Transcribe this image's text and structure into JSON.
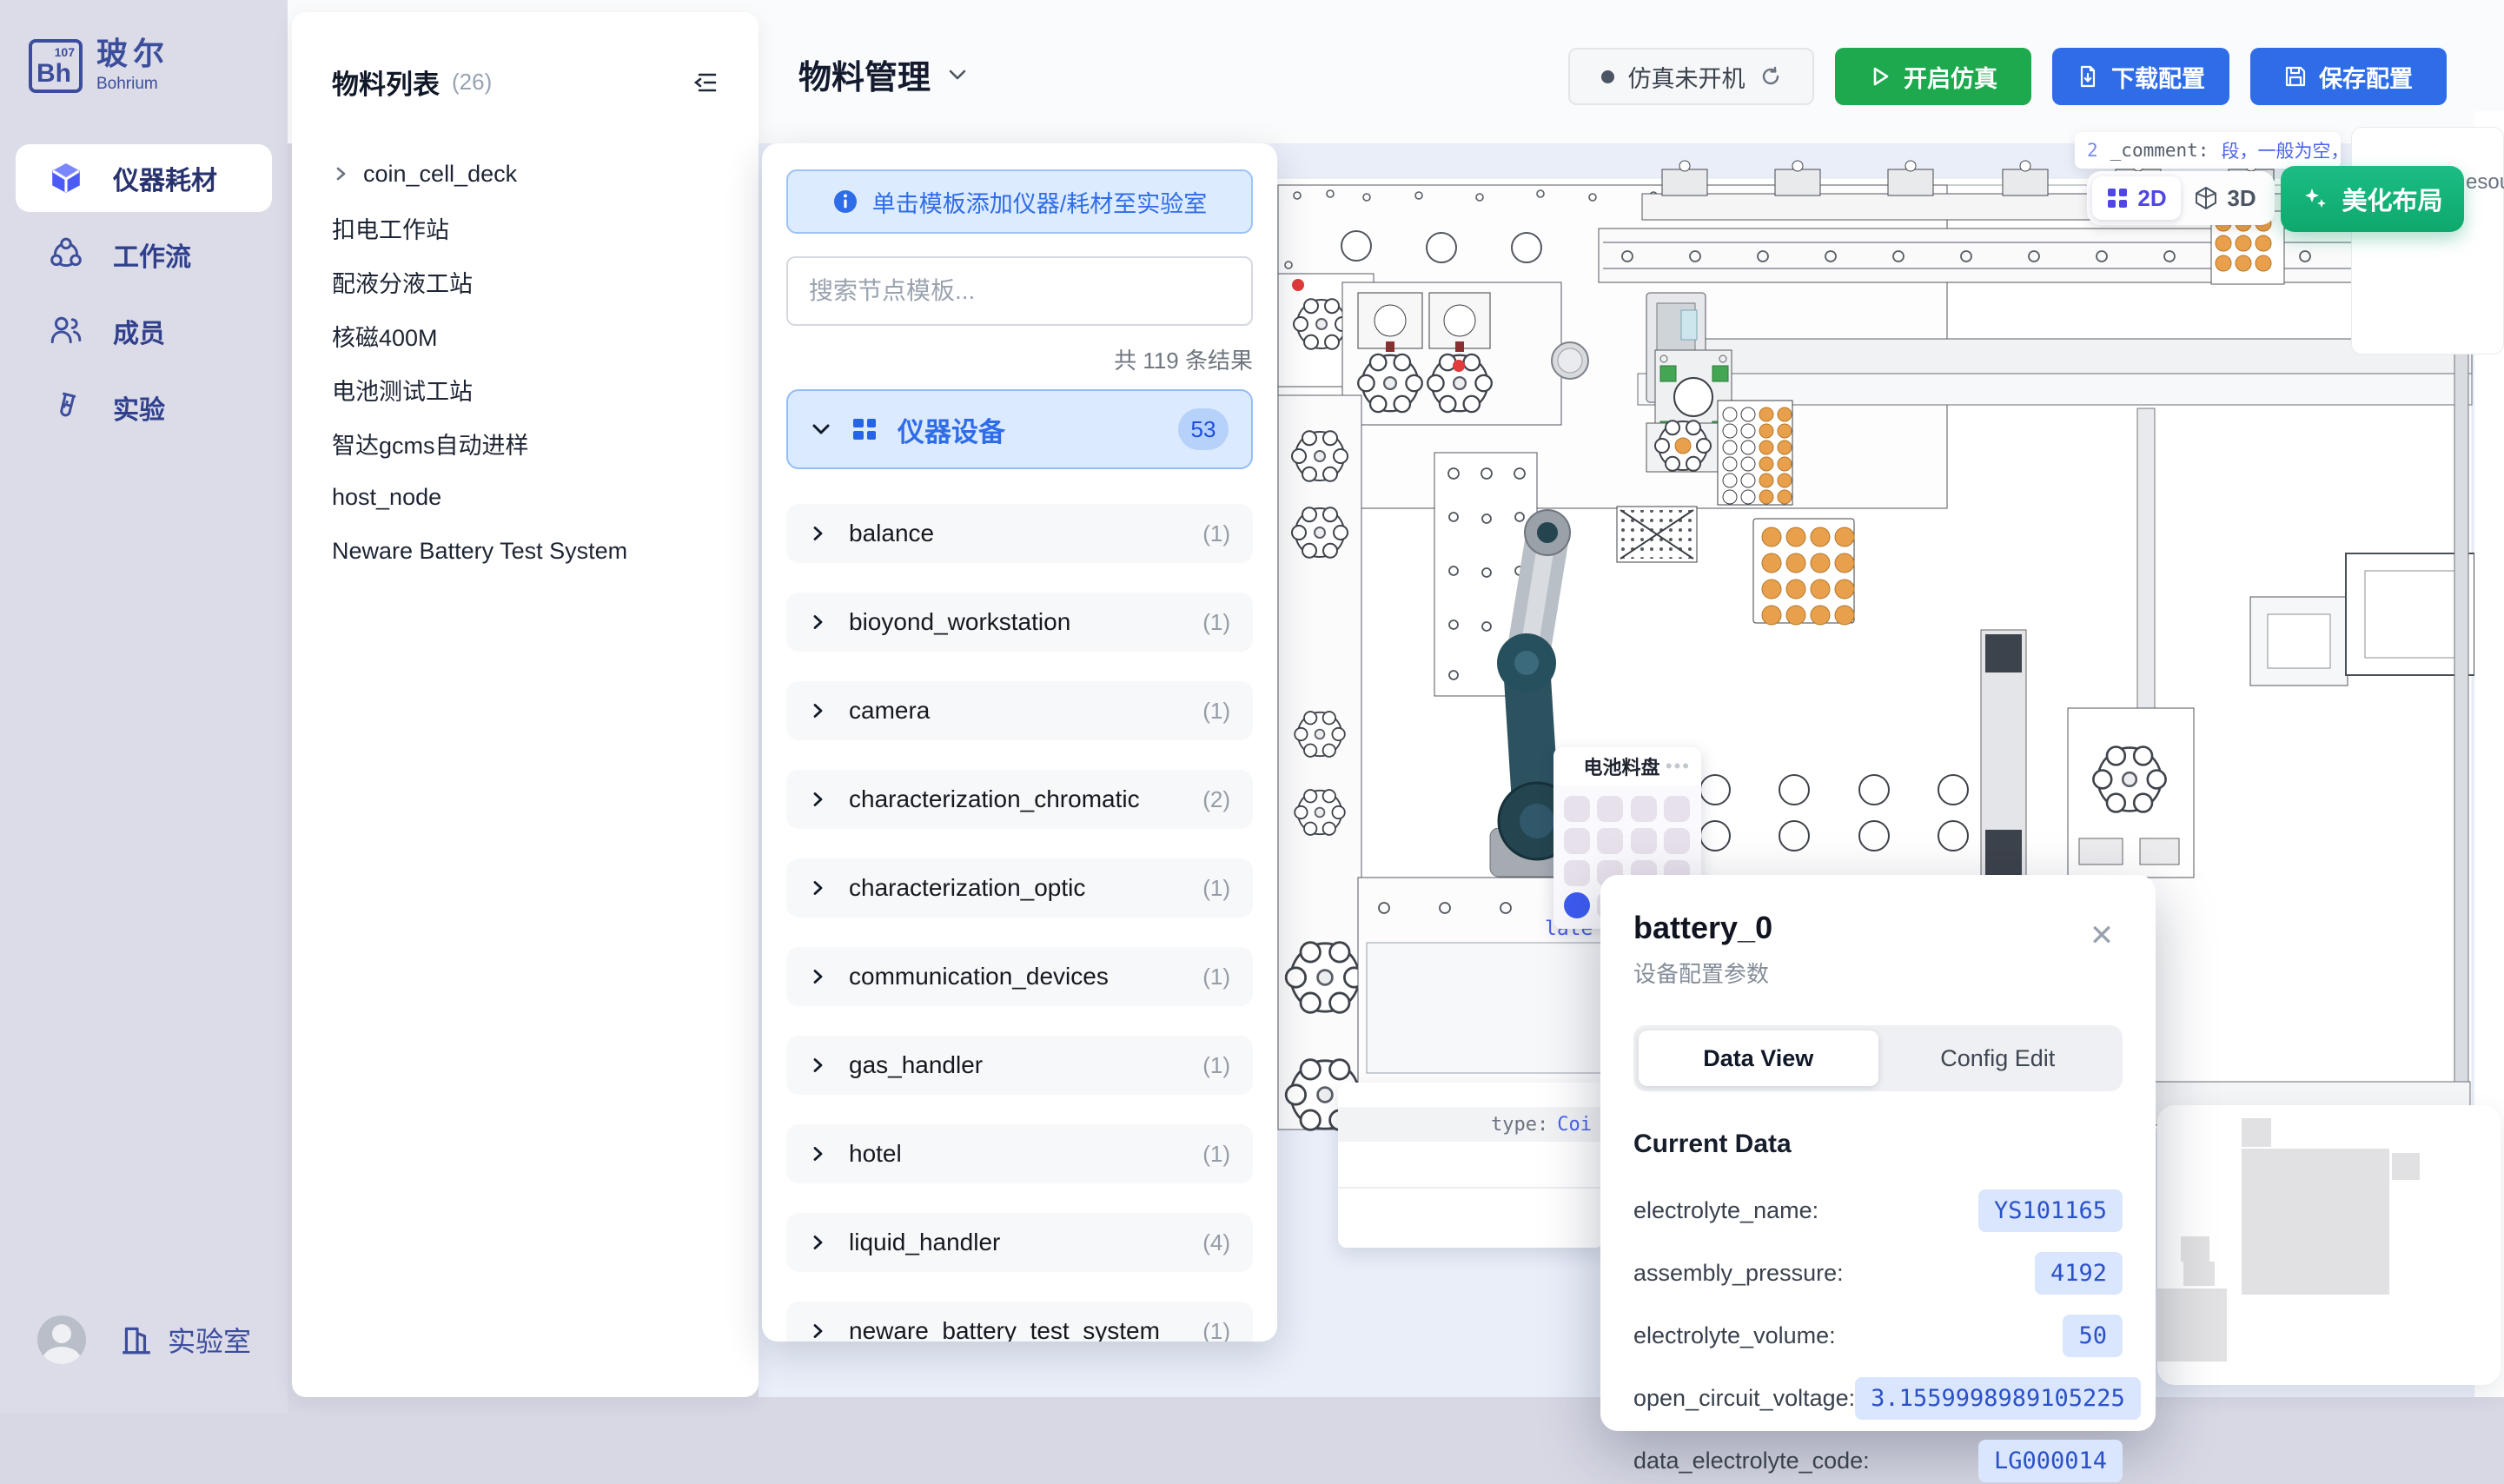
{
  "brand": {
    "logo_symbol": "Bh",
    "logo_number": "107",
    "name_cn": "玻尔",
    "name_en": "Bohrium"
  },
  "sidebar": {
    "items": [
      {
        "icon": "cube-icon",
        "label": "仪器耗材",
        "active": true
      },
      {
        "icon": "workflow-icon",
        "label": "工作流",
        "active": false
      },
      {
        "icon": "members-icon",
        "label": "成员",
        "active": false
      },
      {
        "icon": "experiment-icon",
        "label": "实验",
        "active": false
      }
    ],
    "bottom_label": "实验室"
  },
  "materials": {
    "title": "物料列表",
    "count": "(26)",
    "items": [
      {
        "label": "coin_cell_deck",
        "expandable": true
      },
      {
        "label": "扣电工作站"
      },
      {
        "label": "配液分液工站"
      },
      {
        "label": "核磁400M"
      },
      {
        "label": "电池测试工站"
      },
      {
        "label": "智达gcms自动进样"
      },
      {
        "label": "host_node"
      },
      {
        "label": "Neware Battery Test System"
      }
    ]
  },
  "header": {
    "title": "物料管理",
    "status_label": "仿真未开机",
    "buttons": {
      "start": "开启仿真",
      "download": "下载配置",
      "save": "保存配置"
    }
  },
  "template_panel": {
    "hint": "单击模板添加仪器/耗材至实验室",
    "search_placeholder": "搜索节点模板...",
    "result_count": "共 119 条结果",
    "section": {
      "label": "仪器设备",
      "badge": "53"
    },
    "items": [
      {
        "label": "balance",
        "count": "(1)"
      },
      {
        "label": "bioyond_workstation",
        "count": "(1)"
      },
      {
        "label": "camera",
        "count": "(1)"
      },
      {
        "label": "characterization_chromatic",
        "count": "(2)"
      },
      {
        "label": "characterization_optic",
        "count": "(1)"
      },
      {
        "label": "communication_devices",
        "count": "(1)"
      },
      {
        "label": "gas_handler",
        "count": "(1)"
      },
      {
        "label": "hotel",
        "count": "(1)"
      },
      {
        "label": "liquid_handler",
        "count": "(4)"
      },
      {
        "label": "neware_battery_test_system",
        "count": "(1)"
      }
    ]
  },
  "canvas": {
    "tooltip": {
      "line_no": "2",
      "key": "_comment:",
      "value": "段，一般为空，stat",
      "line2": "固定"
    },
    "view_toggle": {
      "d2": "2D",
      "d3": "3D"
    },
    "beautify_label": "美化布局",
    "clipped_text": "esou",
    "tray": {
      "title": "电池料盘",
      "rows": 4,
      "cols": 4,
      "selected_index": 12
    },
    "hover": {
      "plate_fragment": "late",
      "type_label": "type:",
      "type_value": "Coi"
    }
  },
  "popup": {
    "title": "battery_0",
    "subtitle": "设备配置参数",
    "tabs": [
      "Data View",
      "Config Edit"
    ],
    "active_tab": 0,
    "section": "Current Data",
    "rows": [
      {
        "label": "electrolyte_name:",
        "value": "YS101165"
      },
      {
        "label": "assembly_pressure:",
        "value": "4192"
      },
      {
        "label": "electrolyte_volume:",
        "value": "50"
      },
      {
        "label": "open_circuit_voltage:",
        "value": "3.1559998989105225"
      },
      {
        "label": "data_electrolyte_code:",
        "value": "LG000014"
      }
    ]
  },
  "colors": {
    "accent_blue": "#2f6ce8",
    "accent_green": "#1ea94e",
    "accent_teal": "#12b279",
    "accent_indigo": "#4f46e5",
    "selection_blue": "#3d5bf1",
    "pill_bg": "#d9e6fd",
    "pill_text": "#2b51c8",
    "sidebar_ink": "#3c4d9c",
    "orange_vial": "#e8a04c"
  }
}
